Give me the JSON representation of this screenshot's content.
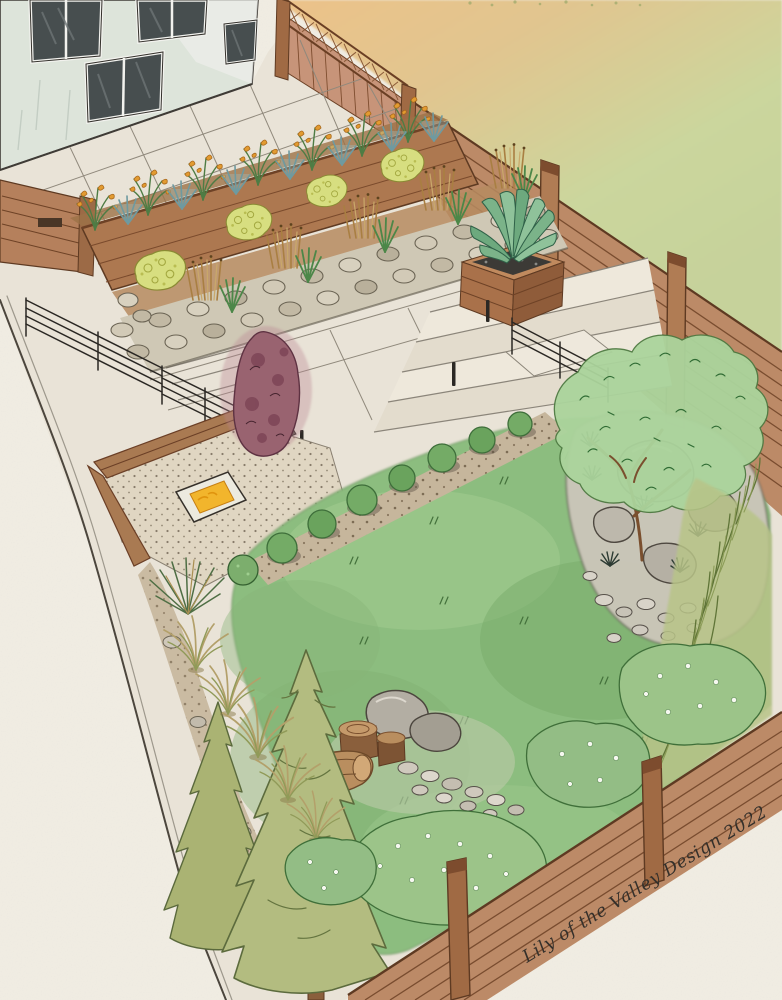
{
  "artwork": {
    "medium": "watercolor and ink landscape design rendering",
    "scene": "backyard garden perspective: house with patio, terraced planting beds, stone retaining wall, fire pit lounge, agave planter, lawn, rock garden with specimen tree, conifers and wood fences",
    "signature": "Lily of the Valley Design 2022",
    "designer": "Lily of the Valley Design",
    "year": "2022",
    "elements": [
      "house",
      "paver patio",
      "lattice-top fence",
      "horizontal slat fence",
      "raised cedar planter bed",
      "yellow crocosmia flowers",
      "blue fescue grasses",
      "stone retaining wall bed",
      "chartreuse shrubs",
      "ornamental reed grasses",
      "agave planter box",
      "concrete steps",
      "cable railing",
      "gravel fire pit lounge",
      "fire table",
      "wood bench",
      "burgundy specimen shrub",
      "lawn",
      "boxwood border",
      "mulch strip",
      "rock garden",
      "specimen tree",
      "boulders",
      "river rocks",
      "grass screen",
      "log and boulder feature",
      "fountain grasses",
      "yucca grass",
      "conifer trees",
      "flowering shrubs",
      "property line",
      "artist signature"
    ]
  },
  "palette": {
    "paper": "#f1ede3",
    "wash_warm": "#ecc289",
    "wash_green": "#cbd69d",
    "house_wall": "#dde4da",
    "window_glass": "#474e4f",
    "concrete": "#e9e3d7",
    "fence_wood": "#bc8a67",
    "fence_dark": "#6e4226",
    "planter_wood": "#ad7850",
    "soil": "#9c7247",
    "stone": "#cfc8b5",
    "gravel": "#e0d6c2",
    "lawn": "#8cbd7f",
    "lawn_shadow": "#76a868",
    "lawn_light": "#a3cd92",
    "mulch": "#c6b69c",
    "boxwood": "#74ab66",
    "flower_orange": "#e09a32",
    "blue_grass": "#6e9aa0",
    "chartreuse": "#d7de80",
    "tan_grass": "#ad8448",
    "fire_glow": "#f2b52c",
    "bench_wood": "#a97a52",
    "burgundy": "#996370",
    "rock": "#b5b0a4",
    "tree_green": "#abd49c",
    "conifer": "#b3bc80",
    "shrub_green": "#9cc489",
    "ink": "#34302b"
  }
}
